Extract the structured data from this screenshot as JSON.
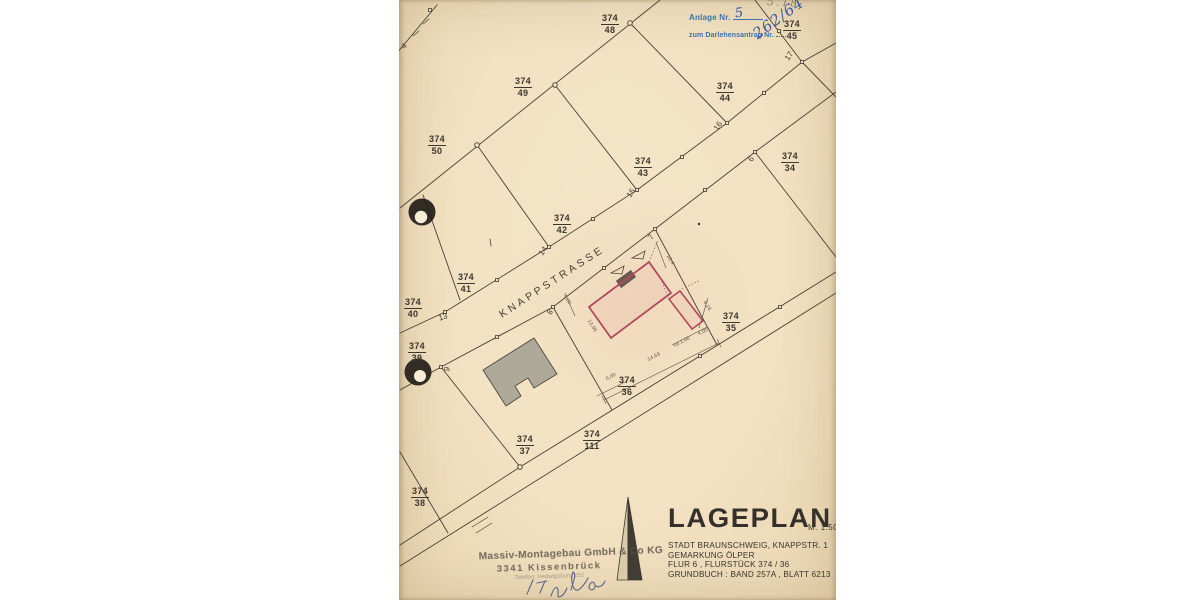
{
  "scan": {
    "paper_color": "#f1e0c1",
    "red_outline_color": "#b04a5c",
    "street": {
      "name": "KNAPPSTRASSE"
    },
    "pencil_note": "5.18",
    "blue_stamp": {
      "color": "#3c72ab",
      "ink_color": "#2b4e9e",
      "line1_label": "Anlage Nr.",
      "line1_value": "5",
      "line2_label": "zum Darlehensantrag Nr.",
      "line2_value": "262/64"
    },
    "parcels": [
      {
        "num": "374",
        "sub": "48",
        "x": 211,
        "y": 14
      },
      {
        "num": "374",
        "sub": "45",
        "x": 393,
        "y": 20
      },
      {
        "num": "374",
        "sub": "49",
        "x": 124,
        "y": 77
      },
      {
        "num": "374",
        "sub": "44",
        "x": 326,
        "y": 82
      },
      {
        "num": "374",
        "sub": "50",
        "x": 38,
        "y": 135
      },
      {
        "num": "374",
        "sub": "43",
        "x": 244,
        "y": 157
      },
      {
        "num": "374",
        "sub": "34",
        "x": 391,
        "y": 152
      },
      {
        "num": "374",
        "sub": "42",
        "x": 163,
        "y": 214
      },
      {
        "num": "374",
        "sub": "41",
        "x": 67,
        "y": 273
      },
      {
        "num": "374",
        "sub": "40",
        "x": 14,
        "y": 298
      },
      {
        "num": "374",
        "sub": "35",
        "x": 332,
        "y": 312
      },
      {
        "num": "374",
        "sub": "39",
        "x": 18,
        "y": 342
      },
      {
        "num": "374",
        "sub": "36",
        "x": 228,
        "y": 376
      },
      {
        "num": "374",
        "sub": "37",
        "x": 126,
        "y": 435
      },
      {
        "num": "374",
        "sub": "111",
        "x": 193,
        "y": 430
      },
      {
        "num": "374",
        "sub": "38",
        "x": 21,
        "y": 487
      }
    ],
    "boundary_markers": [
      {
        "label": "4",
        "x": 5,
        "y": 46,
        "rot": -40
      },
      {
        "label": "17",
        "x": 390,
        "y": 56,
        "rot": -55
      },
      {
        "label": "16",
        "x": 319,
        "y": 126,
        "rot": -55
      },
      {
        "label": "15",
        "x": 232,
        "y": 193,
        "rot": -55
      },
      {
        "label": "14",
        "x": 144,
        "y": 251,
        "rot": -55
      },
      {
        "label": "13",
        "x": 44,
        "y": 317,
        "rot": -15
      },
      {
        "label": "6",
        "x": 352,
        "y": 159,
        "rot": -55
      },
      {
        "label": "7",
        "x": 252,
        "y": 237,
        "rot": -55
      },
      {
        "label": "8",
        "x": 151,
        "y": 312,
        "rot": -55
      },
      {
        "label": "9",
        "x": 48,
        "y": 369,
        "rot": -70
      }
    ],
    "dimensions": [
      {
        "text": "14,69",
        "x": 255,
        "y": 357,
        "rot": -27
      },
      {
        "text": "6,00",
        "x": 212,
        "y": 377,
        "rot": -27
      },
      {
        "text": "13,96",
        "x": 193,
        "y": 326,
        "rot": 58
      },
      {
        "text": "4,86",
        "x": 168,
        "y": 300,
        "rot": 58
      },
      {
        "text": "10,4",
        "x": 271,
        "y": 260,
        "rot": 58
      },
      {
        "text": "8,16",
        "x": 308,
        "y": 306,
        "rot": 58
      },
      {
        "text": "ca.1,00",
        "x": 283,
        "y": 342,
        "rot": -27
      },
      {
        "text": "4,00",
        "x": 304,
        "y": 332,
        "rot": -27
      }
    ],
    "title_block": {
      "title": "LAGEPLAN",
      "scale": "M. 1:500",
      "lines": [
        "STADT  BRAUNSCHWEIG, KNAPPSTR. 1",
        "GEMARKUNG  ÖLPER",
        "FLUR 6 , FLURSTÜCK   374 / 36",
        "GRUNDBUCH : BAND 257A , BLATT 6213"
      ]
    },
    "company_stamp": {
      "line1": "Massiv-Montagebau GmbH & Co KG",
      "line2": "3341 Kissenbrück",
      "line3": "Telefon: Hedwigsburg 252"
    }
  }
}
